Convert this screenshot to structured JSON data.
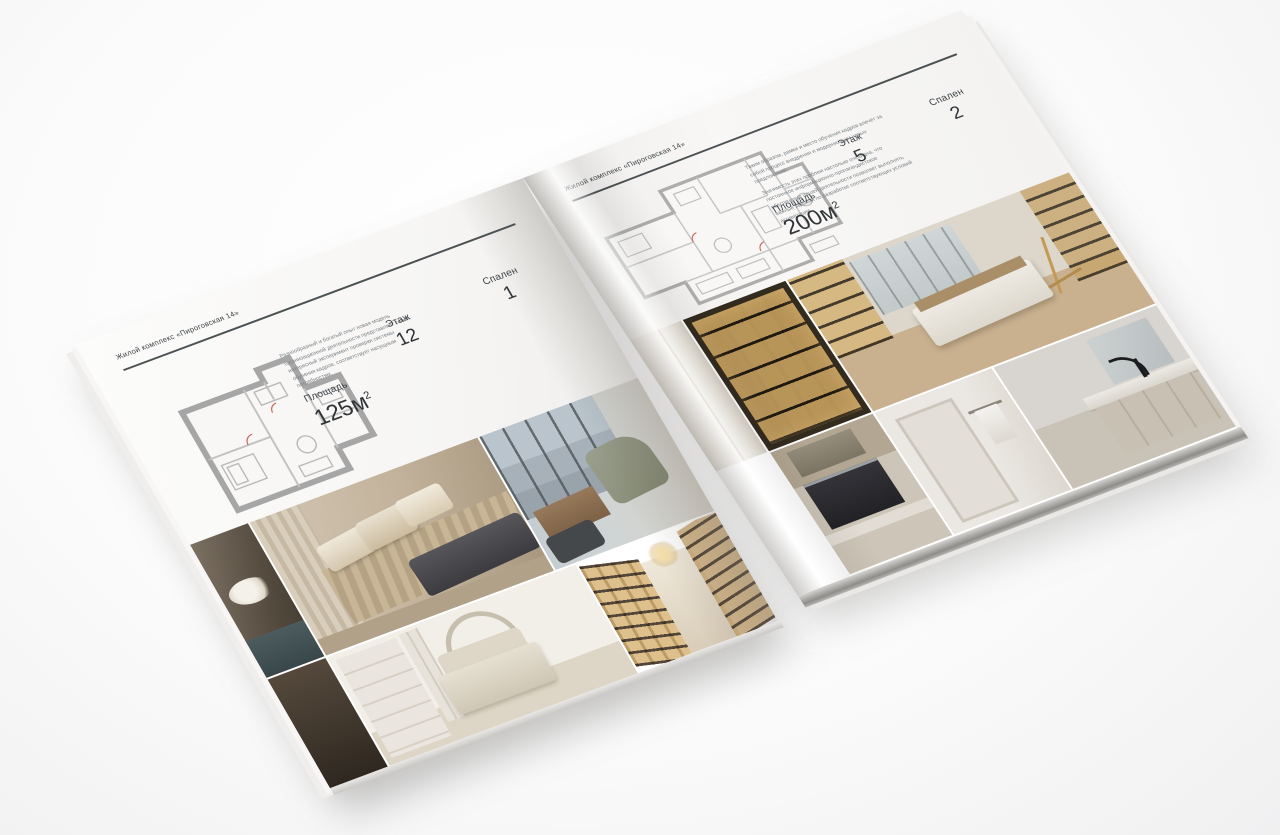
{
  "left_page": {
    "header": "Жилой комплекс «Пироговская 14»",
    "description": "Разнообразный и богатый опыт новая модель организационной деятельности представляет собой интересный эксперимент проверки системы обучения кадров, соответствует насущным потребностям.",
    "area_label": "Площадь",
    "area_value": "125м",
    "area_sup": "2",
    "floor_label": "Этаж",
    "floor_value": "12",
    "bedrooms_label": "Спален",
    "bedrooms_value": "1"
  },
  "right_page": {
    "header": "Жилой комплекс «Пироговская 14»",
    "description_p1": "Таким образом, рамки и место обучения кадров влечёт за собой процесс внедрения и модернизации новых предложений.",
    "description_p2": "Значимость этих проблем настолько очевидна, что постоянное информационно-пропагандистское обеспечение нашей деятельности позволяет выполнять важные задания по разработке соответствующих условий активизации.",
    "area_label": "Площадь",
    "area_value": "200м",
    "area_sup": "2",
    "floor_label": "Этаж",
    "floor_value": "5",
    "bedrooms_label": "Спален",
    "bedrooms_value": "2"
  },
  "photos": {
    "left": [
      "dresser-with-flowers",
      "bedroom-suite",
      "living-room-window",
      "dark-closet",
      "arch-bedroom",
      "library-hallway"
    ],
    "right": [
      "wardrobe-pillar",
      "lit-wardrobe",
      "dressing-room-island",
      "kitchen-range",
      "hallway-towel",
      "bathroom-vanity"
    ]
  },
  "colors": {
    "paper": "#f6f5f3",
    "text_dark": "#2f3438",
    "text_muted": "#7c8287",
    "rule": "#4c5154",
    "plan_wall": "#a6a6a6",
    "photo_beige": "#c2b29b",
    "photo_dark": "#3f3a33",
    "photo_gold": "#c9a86b",
    "backdrop": "#f0f0f1"
  }
}
